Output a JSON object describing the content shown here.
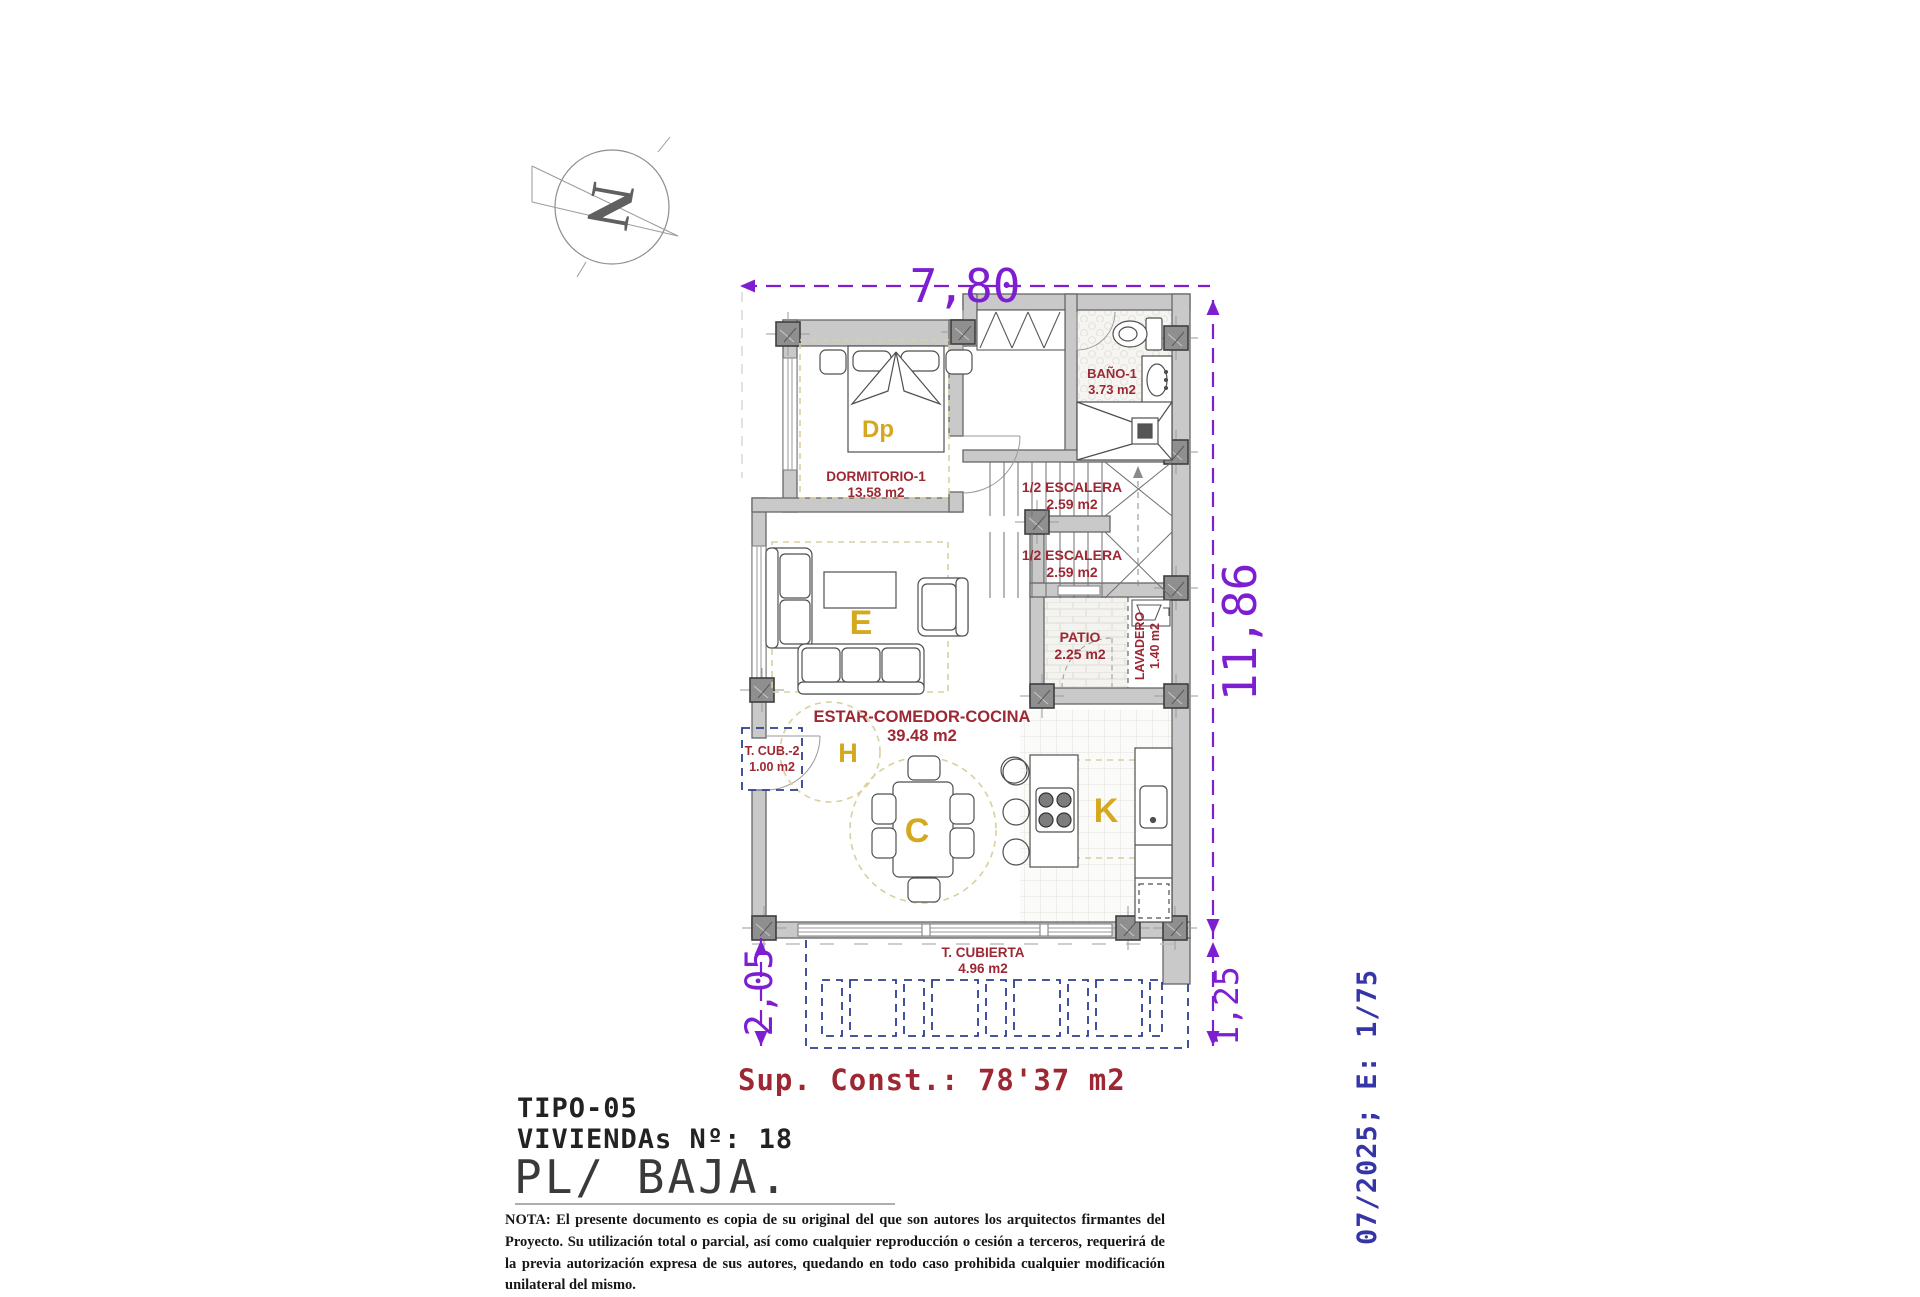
{
  "title_block": {
    "tipo": "TIPO-05",
    "viviendas": "VIVIENDAs Nº: 18",
    "planta": "PL/ BAJA.",
    "nota": "NOTA: El presente documento es copia de su original del que son autores los arquitectos firmantes del Proyecto. Su utilización total o parcial, así como cualquier reproducción o cesión a terceros, requerirá  de la previa autorización expresa de sus autores, quedando en todo caso prohibida cualquier modificación unilateral del mismo."
  },
  "side_note": "07/2025; E: 1/75",
  "summary": {
    "sup_const": "Sup. Const.: 78'37 m2"
  },
  "dimensions": {
    "top": "7,80",
    "right": "11,86",
    "bottom_left": "2,05",
    "bottom_right": "1,25"
  },
  "compass": {
    "letter": "N"
  },
  "rooms": {
    "dormitorio": {
      "name": "DORMITORIO-1",
      "area": "13.58 m2"
    },
    "bano": {
      "name": "BAÑO-1",
      "area": "3.73 m2"
    },
    "escalera_sup": {
      "name": "1/2 ESCALERA",
      "area": "2.59 m2"
    },
    "escalera_inf": {
      "name": "1/2 ESCALERA",
      "area": "2.59 m2"
    },
    "patio": {
      "name": "PATIO",
      "area": "2.25 m2"
    },
    "lavadero": {
      "name": "LAVADERO",
      "area": "1.40 m2"
    },
    "estar": {
      "name": "ESTAR-COMEDOR-COCINA",
      "area": "39.48 m2"
    },
    "tcub2": {
      "name": "T. CUB.-2",
      "area": "1.00 m2"
    },
    "tcubierta": {
      "name": "T. CUBIERTA",
      "area": "4.96 m2"
    }
  },
  "zones": {
    "dormitorio": "Dp",
    "estar": "E",
    "hall": "H",
    "comedor": "C",
    "cocina": "K"
  },
  "colors": {
    "dimension_purple": "#7d1fd0",
    "room_label_red": "#9d2733",
    "zone_label_yellow": "#d6a81f",
    "side_note_indigo": "#3535a6",
    "pergola_navy": "#2e3f90",
    "wall_gray": "#c9c9c9"
  }
}
